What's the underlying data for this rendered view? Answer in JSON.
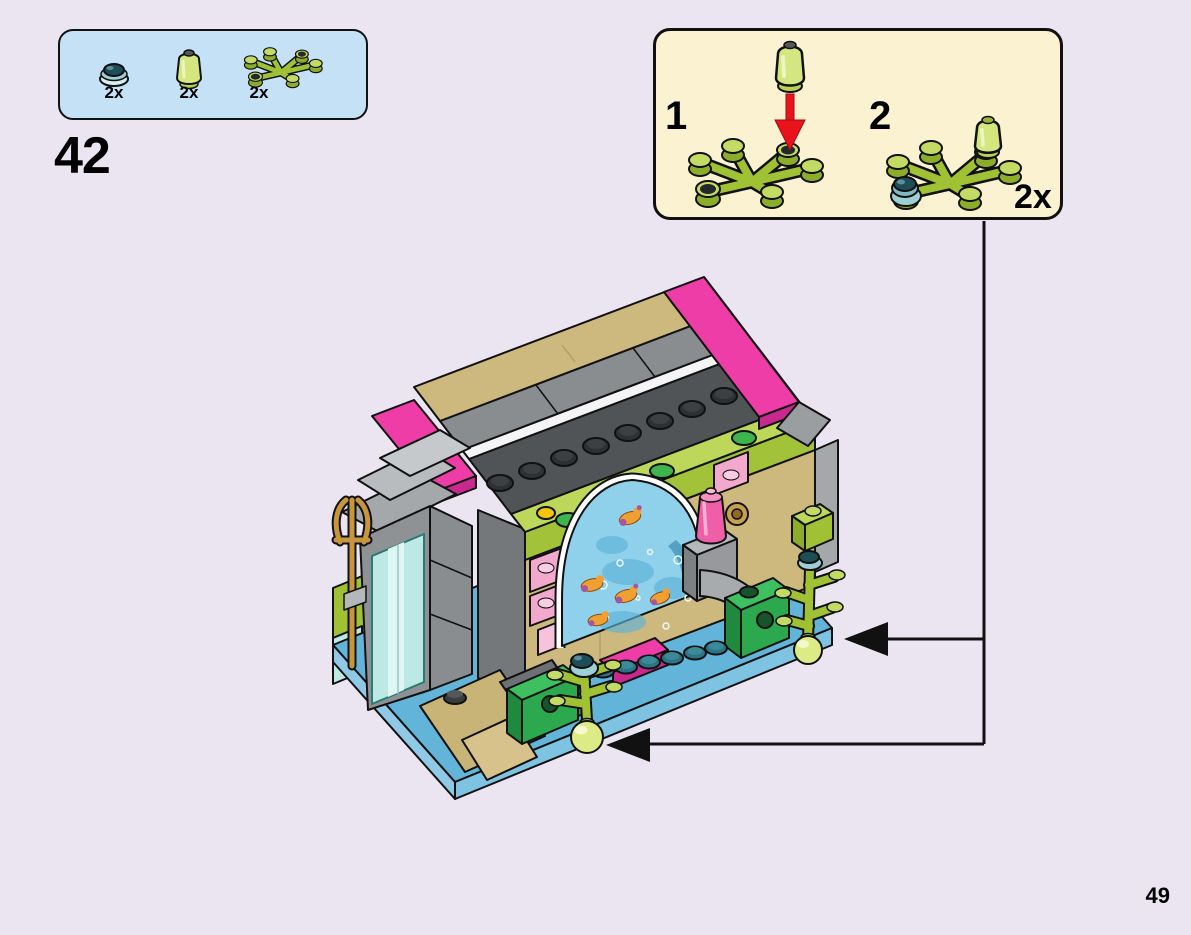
{
  "page": {
    "step_number": "42",
    "page_number": "49",
    "background_color": "#ebe5f2"
  },
  "parts_box": {
    "background_color": "#c4e1f6",
    "items": [
      {
        "part": "trans-teal-round-tile",
        "count": "2x"
      },
      {
        "part": "trans-lime-bottle",
        "count": "2x"
      },
      {
        "part": "lime-seagrass-plant",
        "count": "2x"
      }
    ]
  },
  "callout": {
    "background_color": "#fbf2d2",
    "quantity": "2x",
    "arrow_color": "#e8131b",
    "substeps": [
      {
        "label": "1",
        "action": "attach trans-lime bottle onto plant stud"
      },
      {
        "label": "2",
        "action": "plant with trans-teal tile and bottle attached"
      }
    ]
  },
  "model": {
    "subject": "aquarium-gateway-assembly",
    "key_colors": {
      "lime": "#9fc133",
      "magenta": "#ef3da8",
      "tan": "#cdb97e",
      "base_blue": "#62b5d8",
      "green": "#2ca94f",
      "trans_pink": "#f3a9cd",
      "water_blue": "#8fd0ea",
      "gold": "#c8953f",
      "dark_gray": "#515457"
    }
  }
}
